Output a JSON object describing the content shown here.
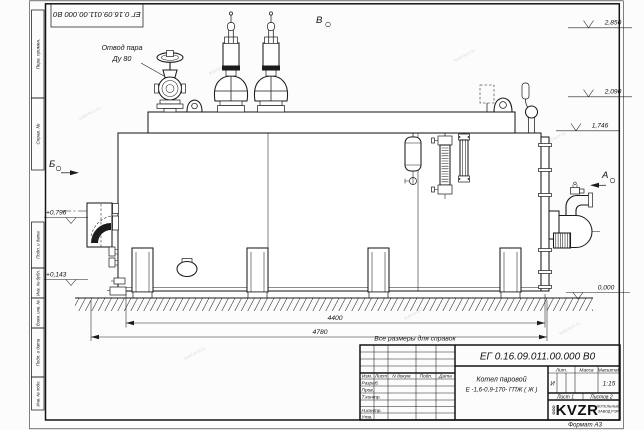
{
  "watermark": "kotel-kvzr.kz",
  "corner_stamp": "ЕГ 0.16.09.011.00.000  В0",
  "margin_labels": [
    "Перв. примен.",
    "Справ. №",
    "Подп. и дата",
    "Инв. № дубл.",
    "Взам. инв. №",
    "Подп. и дата",
    "Инв. № подл."
  ],
  "annotations": {
    "steam_outlet_line1": "Отвод пара",
    "steam_outlet_line2": "Ду 80",
    "view_a": "А",
    "view_b": "Б",
    "view_v": "В",
    "note": "Все размеры для справок"
  },
  "dimensions": {
    "length_main": "4400",
    "length_overall": "4780"
  },
  "elevations": {
    "top": "2,850",
    "safety_valve": "2,090",
    "drum_top": "1,746",
    "burner_axis": "+0,796",
    "lower_nozzle": "+0,143",
    "ground": "0,000"
  },
  "title_block": {
    "designation": "ЕГ 0.16.09.011.00.000  В0",
    "product_name_line1": "Котел паровой",
    "product_name_line2": "Е -1,6-0,9-170- ГПЖ ( Ж )",
    "columns": {
      "izm": "Изм.",
      "list": "Лист",
      "ndoc": "N докум.",
      "podp": "Подп.",
      "data": "Дата"
    },
    "rows": {
      "razrab": "Разраб.",
      "prov": "Пров.",
      "tkontr": "Т.контр.",
      "nkontr": "Н.контр.",
      "utv": "Утв."
    },
    "lit_header": "Лит.",
    "mass_header": "Масса",
    "scale_header": "Масштаб",
    "lit_value": "И",
    "scale_value": "1:15",
    "sheet_info": "Лист 1",
    "sheets_info": "Листов 2",
    "company_prefix": "ООО",
    "company_name": "KVZR",
    "company_line1": "КОТЕЛЬНЫЙ",
    "company_line2": "ЗАВОД РЭР",
    "format_label": "Формат А3"
  }
}
